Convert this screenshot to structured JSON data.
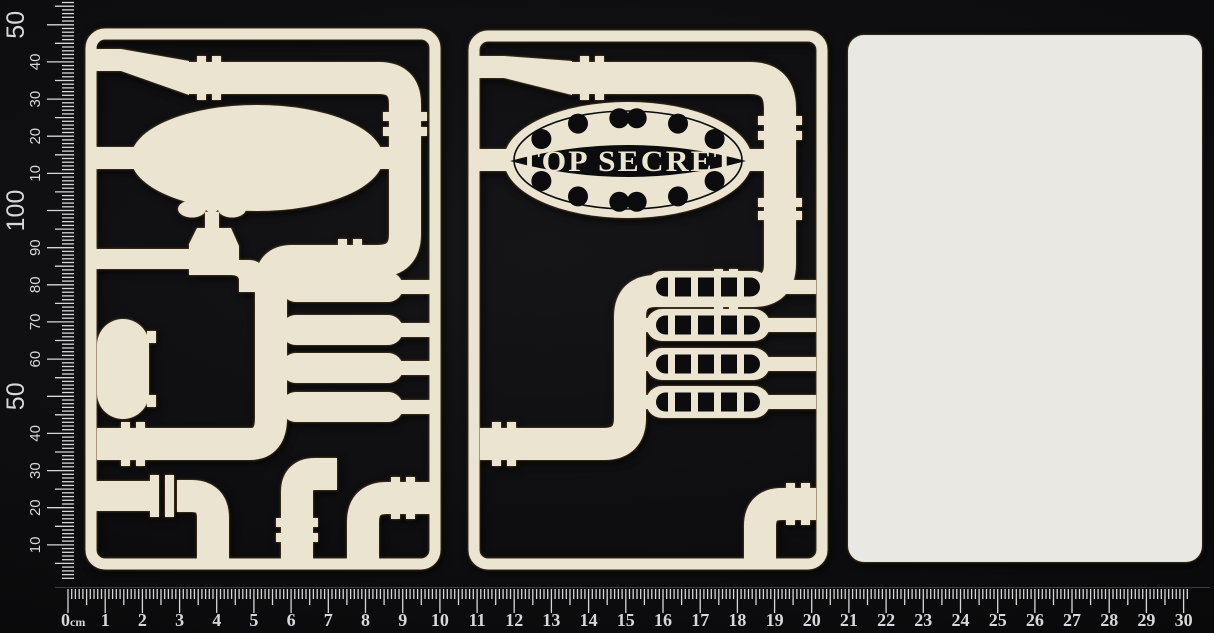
{
  "scene": {
    "background": "#0c0c0e"
  },
  "colors": {
    "chipboard": "#eae4d1",
    "board_white": "#e9e8e2",
    "backing_black": "#0c0c0e",
    "ruler_ink": "#d6d7da"
  },
  "rulers": {
    "vertical": {
      "unit": "mm",
      "labels": [
        {
          "mm": 10,
          "t": "10",
          "big": false
        },
        {
          "mm": 20,
          "t": "20",
          "big": false
        },
        {
          "mm": 30,
          "t": "30",
          "big": false
        },
        {
          "mm": 40,
          "t": "40",
          "big": false
        },
        {
          "mm": 50,
          "t": "50",
          "big": true
        },
        {
          "mm": 60,
          "t": "60",
          "big": false
        },
        {
          "mm": 70,
          "t": "70",
          "big": false
        },
        {
          "mm": 80,
          "t": "80",
          "big": false
        },
        {
          "mm": 90,
          "t": "90",
          "big": false
        },
        {
          "mm": 100,
          "t": "100",
          "big": true
        },
        {
          "mm": 110,
          "t": "10",
          "big": false
        },
        {
          "mm": 120,
          "t": "20",
          "big": false
        },
        {
          "mm": 130,
          "t": "30",
          "big": false
        },
        {
          "mm": 140,
          "t": "40",
          "big": false
        },
        {
          "mm": 150,
          "t": "50",
          "big": true
        }
      ]
    },
    "horizontal": {
      "unit": "cm",
      "zero_number": "0",
      "zero_unit": "cm",
      "numbers": [
        "1",
        "2",
        "3",
        "4",
        "5",
        "6",
        "7",
        "8",
        "9",
        "10",
        "11",
        "12",
        "13",
        "14",
        "15",
        "16",
        "17",
        "18",
        "19",
        "20",
        "21",
        "22",
        "23",
        "24",
        "25",
        "26",
        "27",
        "28",
        "29",
        "30"
      ]
    }
  },
  "panels": {
    "middle": {
      "banner_text": "TOP SECRET"
    }
  }
}
